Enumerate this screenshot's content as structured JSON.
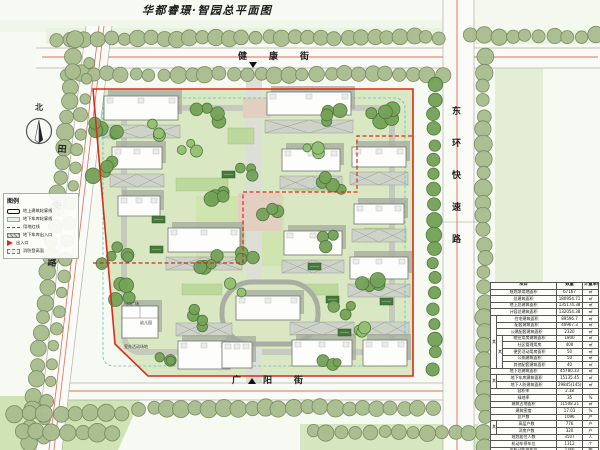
{
  "title": "华都睿璟·智园总平面图",
  "north_label": "北",
  "streets": {
    "top": "健康街",
    "right": "东环快速路",
    "left": "田安路",
    "bottom": "广阳街"
  },
  "site_labels": {
    "entry_plaza": "入口广场",
    "kindergarten": "幼儿园",
    "playground": "室外活动场地"
  },
  "legend": {
    "title": "图例",
    "items": [
      {
        "key": "building-outline",
        "label": "地上建筑轮廓线"
      },
      {
        "key": "garage-outline",
        "label": "地下车库轮廓线"
      },
      {
        "key": "red-line",
        "label": "用地红线"
      },
      {
        "key": "garage-entrance",
        "label": "地下车库出入口"
      },
      {
        "key": "entrance",
        "label": "出入口"
      },
      {
        "key": "fire-surface",
        "label": "消防登高面"
      }
    ]
  },
  "table": {
    "headers": [
      "项目",
      "数量",
      "计量单位"
    ],
    "rows": [
      [
        "规划净用地面积",
        "67167",
        "㎡"
      ],
      [
        "总建筑面积",
        "180954.71",
        "㎡"
      ],
      [
        "地上总建筑面积",
        "135174.38",
        "㎡"
      ],
      [
        "计容总建筑面积",
        "132054.38",
        "㎡"
      ],
      [
        "住宅建筑面积",
        "89596.7",
        "㎡"
      ],
      [
        "配套建筑面积",
        "40967.3",
        "㎡"
      ],
      [
        "公建配套建筑面积",
        "2320",
        "㎡"
      ],
      [
        "物业用房建筑面积",
        "1800",
        "㎡"
      ],
      [
        "社区管理用房",
        "400",
        "㎡"
      ],
      [
        "便民活动用房面积",
        "50",
        "㎡"
      ],
      [
        "公厕建筑面积",
        "50",
        "㎡"
      ],
      [
        "其他配套建筑面积",
        "40",
        "㎡"
      ],
      [
        "地下总建筑面积",
        "45780.33",
        "㎡"
      ],
      [
        "地下车库建筑面积",
        "15135.45",
        "㎡"
      ],
      [
        "地下人防建筑面积",
        "29845(145)",
        "㎡"
      ],
      [
        "容积率",
        "2.38",
        ""
      ],
      [
        "绿地率",
        "35",
        "%"
      ],
      [
        "建筑占地面积",
        "11508.21",
        "㎡"
      ],
      [
        "建筑密度",
        "17.03",
        "%"
      ],
      [
        "总户数",
        "1096",
        "户"
      ],
      [
        "高层户数",
        "776",
        "户"
      ],
      [
        "洋房户数",
        "320",
        "户"
      ],
      [
        "规划居住人数",
        "3507",
        "人"
      ],
      [
        "机动车停车位",
        "1312",
        "个"
      ],
      [
        "非机动车停车位",
        "2366",
        "辆"
      ]
    ],
    "merges": [
      {
        "row": 4,
        "level": 1,
        "label": "其中",
        "span": 8
      },
      {
        "row": 7,
        "level": 2,
        "label": "其中",
        "span": 5
      },
      {
        "row": 13,
        "level": 1,
        "label": "其中",
        "span": 2
      },
      {
        "row": 20,
        "level": 1,
        "label": "其中",
        "span": 2
      }
    ]
  },
  "colors": {
    "lawn": "#d9e8c2",
    "sage": "#a9bd8f",
    "sageEdge": "#76885c",
    "treeDark": "#74a258",
    "treeDarkEdge": "#4c7239",
    "treeLight": "#93c171",
    "red": "#d92b1c",
    "salmon": "#e06a5a",
    "roadEdge": "#aeb2a8",
    "roadFill": "#fafbf6",
    "buildingStroke": "#70746c",
    "shadow": "#a6aa9e",
    "hatchFill": "#ced2c8",
    "hatchLine": "#98a090",
    "cyan": "#54c4bc",
    "vent": "#47793d",
    "ventEdge": "#2e5229",
    "garden": "#bcd89c",
    "court": "#cfe4ae",
    "paveGray": "#dcdfd6",
    "pink": "#e2cfc2",
    "ringStroke": "#c6cabe",
    "ovalStroke": "#a8aea1"
  },
  "map": {
    "washes": [
      {
        "t": "r",
        "v": [
          0,
          20,
          600,
          12
        ],
        "f": "#f1f6ea"
      },
      {
        "t": "r",
        "v": [
          46,
          28,
          554,
          16
        ],
        "f": "#e9f1df"
      },
      {
        "t": "r",
        "v": [
          476,
          0,
          124,
          30
        ],
        "f": "#f4f8ee"
      },
      {
        "t": "r",
        "v": [
          495,
          55,
          48,
          230
        ],
        "f": "#e4eed7"
      },
      {
        "t": "p",
        "v": [
          [
            0,
            396
          ],
          [
            142,
            396
          ],
          [
            118,
            450
          ],
          [
            0,
            450
          ]
        ],
        "f": "#cfe3b4"
      },
      {
        "t": "r",
        "v": [
          300,
          424,
          178,
          26
        ],
        "f": "#d6e6bf"
      }
    ],
    "roads": {
      "top": {
        "band": [
          36,
          48,
          564,
          20
        ],
        "redY": 57,
        "redX1": 42,
        "redX2": 598
      },
      "bottom": {
        "band": [
          55,
          383,
          400,
          17
        ],
        "redY": 391,
        "redX1": 60,
        "redX2": 452
      },
      "right": {
        "band": [
          443,
          0,
          31,
          450
        ],
        "redX": 457
      },
      "left": {
        "poly": [
          [
            86,
            26
          ],
          [
            112,
            26
          ],
          [
            62,
            450
          ],
          [
            36,
            450
          ]
        ],
        "red1": [
          [
            99,
            26
          ],
          [
            49,
            450
          ]
        ],
        "red2": [
          [
            104,
            26
          ],
          [
            54,
            450
          ]
        ]
      }
    },
    "paths": {
      "ring": [
        124,
        108,
        268,
        244
      ],
      "axis": [
        246,
        68,
        16,
        315
      ],
      "plazas": [
        [
          238,
          193,
          44,
          38
        ],
        [
          243,
          98,
          28,
          20
        ]
      ],
      "gardens": [
        [
          176,
          178,
          52,
          13
        ],
        [
          294,
          178,
          40,
          13
        ],
        [
          182,
          284,
          40,
          11
        ],
        [
          300,
          284,
          38,
          11
        ],
        [
          364,
          228,
          30,
          14
        ],
        [
          228,
          128,
          26,
          16
        ]
      ],
      "court": [
        196,
        196,
        88,
        70
      ],
      "oval": [
        222,
        282,
        96,
        62
      ]
    },
    "buildings": [
      [
        104,
        96,
        74,
        24
      ],
      [
        267,
        92,
        84,
        23
      ],
      [
        112,
        147,
        50,
        22
      ],
      [
        282,
        149,
        58,
        22
      ],
      [
        352,
        147,
        54,
        20
      ],
      [
        118,
        196,
        42,
        20
      ],
      [
        168,
        228,
        72,
        24
      ],
      [
        284,
        231,
        58,
        24
      ],
      [
        354,
        204,
        50,
        20
      ],
      [
        350,
        257,
        58,
        22
      ],
      [
        236,
        296,
        64,
        24
      ],
      [
        178,
        341,
        52,
        28
      ],
      [
        222,
        342,
        30,
        26
      ],
      [
        292,
        340,
        60,
        26
      ],
      [
        363,
        340,
        44,
        26
      ]
    ],
    "kindergarten": [
      122,
      306,
      36,
      32
    ],
    "fire_below": [
      0,
      1,
      2,
      3,
      4,
      6,
      7,
      8,
      9
    ],
    "fire_above": [
      11,
      13,
      14
    ],
    "vents": [
      [
        152,
        216
      ],
      [
        150,
        246
      ],
      [
        308,
        263
      ],
      [
        326,
        296
      ],
      [
        380,
        298
      ],
      [
        222,
        171
      ],
      [
        338,
        329
      ]
    ],
    "tree_rows": [
      [
        58,
        39,
        440,
        37,
        30,
        7,
        "sage"
      ],
      [
        470,
        36,
        596,
        36,
        10,
        7,
        "sage"
      ],
      [
        66,
        74,
        442,
        74,
        28,
        7,
        "sage"
      ],
      [
        484,
        58,
        484,
        446,
        28,
        7.5,
        "sage"
      ],
      [
        76,
        40,
        28,
        442,
        27,
        7.5,
        "sage"
      ],
      [
        88,
        62,
        44,
        436,
        22,
        6,
        "sage"
      ],
      [
        140,
        408,
        432,
        408,
        22,
        7.5,
        "sage"
      ],
      [
        14,
        414,
        122,
        414,
        8,
        8,
        "sage"
      ],
      [
        22,
        432,
        112,
        432,
        7,
        8,
        "sage"
      ],
      [
        312,
        432,
        470,
        432,
        12,
        7,
        "sage"
      ],
      [
        434,
        85,
        434,
        368,
        20,
        6.5,
        "dark"
      ]
    ],
    "clusters": [
      [
        108,
        128,
        5,
        16,
        6,
        0
      ],
      [
        102,
        168,
        4,
        13,
        6,
        0
      ],
      [
        112,
        256,
        5,
        16,
        6,
        0
      ],
      [
        128,
        292,
        4,
        13,
        6,
        0
      ],
      [
        208,
        118,
        4,
        14,
        6,
        0
      ],
      [
        248,
        172,
        3,
        10,
        5,
        0
      ],
      [
        214,
        198,
        4,
        13,
        6,
        0
      ],
      [
        268,
        208,
        3,
        10,
        5,
        0
      ],
      [
        206,
        262,
        4,
        14,
        6,
        0
      ],
      [
        252,
        252,
        3,
        11,
        5,
        0
      ],
      [
        330,
        118,
        4,
        12,
        6,
        0
      ],
      [
        334,
        184,
        4,
        12,
        6,
        0
      ],
      [
        332,
        240,
        3,
        10,
        5,
        0
      ],
      [
        374,
        288,
        4,
        12,
        6,
        0
      ],
      [
        342,
        312,
        3,
        10,
        5,
        0
      ],
      [
        202,
        318,
        4,
        13,
        6,
        0
      ],
      [
        162,
        358,
        3,
        10,
        5,
        0
      ],
      [
        330,
        362,
        3,
        10,
        5,
        0
      ],
      [
        385,
        112,
        5,
        14,
        7,
        0
      ],
      [
        190,
        150,
        3,
        12,
        5,
        1
      ],
      [
        310,
        150,
        3,
        12,
        5,
        1
      ],
      [
        240,
        290,
        3,
        10,
        5,
        1
      ],
      [
        150,
        130,
        3,
        10,
        5,
        1
      ],
      [
        360,
        330,
        3,
        10,
        5,
        1
      ]
    ],
    "boundary": [
      [
        93,
        89
      ],
      [
        413,
        89
      ],
      [
        413,
        376
      ],
      [
        148,
        376
      ],
      [
        115,
        344
      ]
    ],
    "phase": [
      [
        93,
        263
      ],
      [
        243,
        263
      ],
      [
        243,
        192
      ],
      [
        357,
        192
      ],
      [
        357,
        136
      ],
      [
        413,
        136
      ]
    ],
    "cyan": [
      103,
      98,
      302,
      268
    ],
    "entrances": [
      [
        253,
        62,
        "down"
      ],
      [
        252,
        378,
        "up"
      ]
    ],
    "section_line": [
      436,
      222,
      480,
      222
    ]
  }
}
